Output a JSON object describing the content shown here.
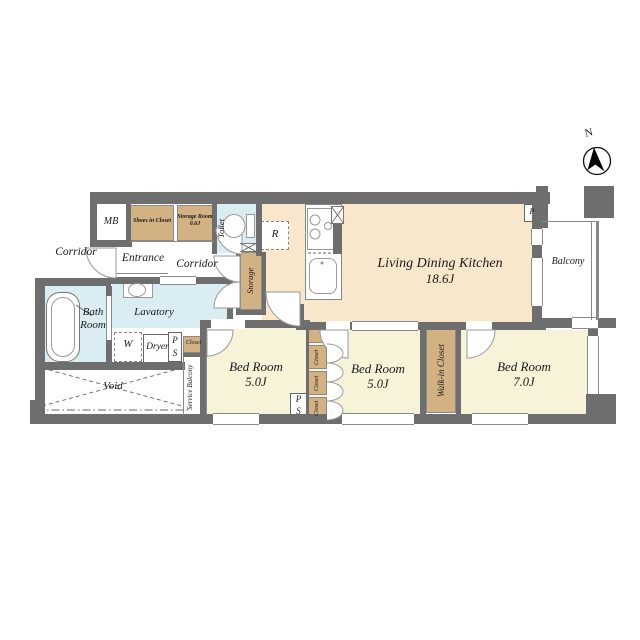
{
  "compass": {
    "north_label": "N"
  },
  "rooms": {
    "living_dining_kitchen": {
      "name": "Living Dining Kitchen",
      "area": "18.6J"
    },
    "bedroom_left": {
      "name": "Bed Room",
      "area": "5.0J"
    },
    "bedroom_middle": {
      "name": "Bed Room",
      "area": "5.0J"
    },
    "bedroom_right": {
      "name": "Bed Room",
      "area": "7.0J"
    },
    "bath": {
      "line1": "Bath",
      "line2": "Room"
    },
    "lavatory": {
      "name": "Lavatory"
    },
    "toilet": {
      "name": "Toilet"
    },
    "entrance": {
      "name": "Entrance"
    },
    "corridor_common": {
      "name": "Corridor"
    },
    "corridor_inner": {
      "name": "Corridor"
    },
    "balcony": {
      "name": "Balcony"
    },
    "service_balcony": {
      "name": "Service Balcony"
    },
    "void": {
      "name": "Void"
    },
    "walk_in_closet": {
      "name": "Walk-in Closet"
    },
    "storage": {
      "name": "Storage"
    },
    "shoes_in_closet": {
      "name": "Shoes in Closet"
    },
    "storage_room": {
      "name": "Storage Room",
      "area": "0.6J"
    },
    "closet_1": {
      "name": "Closet"
    },
    "closet_2": {
      "name": "Closet"
    },
    "closet_3": {
      "name": "Closet"
    },
    "closet_small": {
      "name": "Closet"
    }
  },
  "fixtures": {
    "meter_box": "MB",
    "refrigerator": "R",
    "washer": "W",
    "dryer": "Dryer",
    "pipe_small": "P",
    "pipe_shaft_1": {
      "line1": "P",
      "line2": "S"
    },
    "pipe_shaft_2": {
      "line1": "P",
      "line2": "S"
    }
  },
  "colors": {
    "wall": "#6e6e6e",
    "ldk_fill": "#f8e7cb",
    "bedroom_fill": "#f7f3d8",
    "wet_fill": "#d9edf2",
    "closet_fill": "#d2b183"
  }
}
